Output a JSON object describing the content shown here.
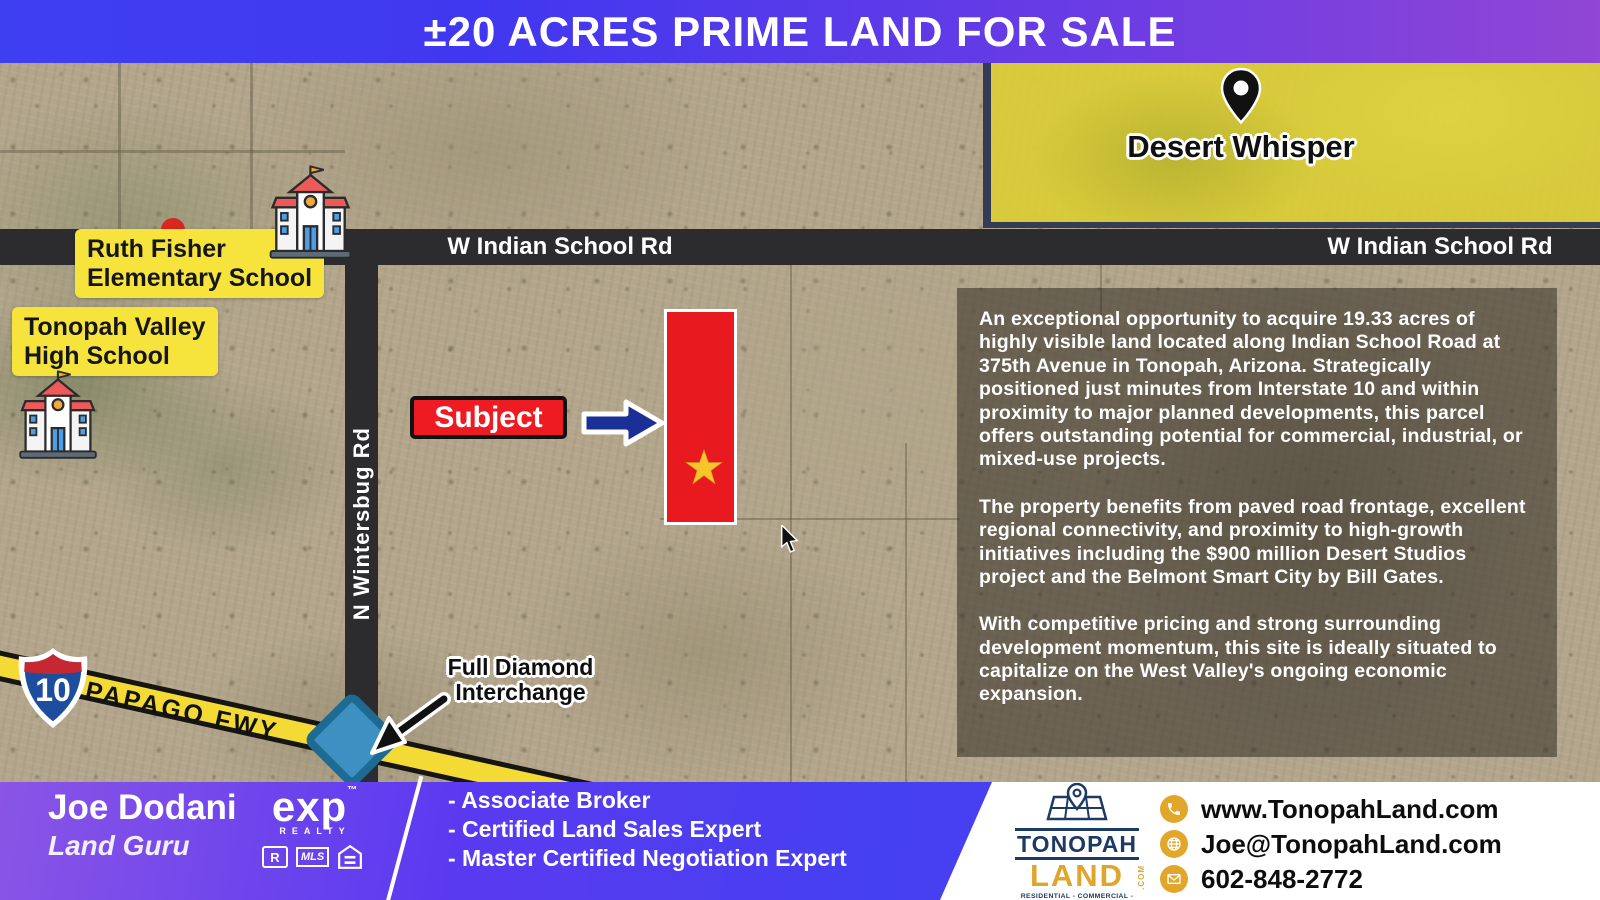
{
  "banner": {
    "title": "±20 ACRES PRIME LAND FOR SALE"
  },
  "map": {
    "desert_whisper": {
      "label": "Desert Whisper"
    },
    "roads": {
      "indian_school": "W Indian School Rd",
      "wintersburg": "N Wintersbug Rd",
      "papago": "PAPAGO FWY",
      "interstate": "10"
    },
    "schools": {
      "ruth_fisher": {
        "line1": "Ruth Fisher",
        "line2": "Elementary School"
      },
      "tonopah_valley": {
        "line1": "Tonopah Valley",
        "line2": "High School"
      }
    },
    "subject": {
      "label": "Subject"
    },
    "interchange": {
      "line1": "Full Diamond",
      "line2": "Interchange"
    },
    "description": {
      "p1": "An exceptional opportunity to acquire 19.33 acres of highly visible land located along Indian School Road at 375th Avenue in Tonopah, Arizona. Strategically positioned just minutes from Interstate 10 and within proximity to major planned developments, this parcel offers outstanding potential for commercial, industrial, or mixed-use projects.",
      "p2": "The property benefits from paved road frontage, excellent regional connectivity, and proximity to high-growth initiatives including the $900 million Desert Studios project and the Belmont Smart City by Bill Gates.",
      "p3": "With competitive pricing and strong surrounding development momentum, this site is ideally situated to capitalize on the West Valley's ongoing economic expansion."
    }
  },
  "footer": {
    "agent": {
      "name": "Joe Dodani",
      "title": "Land Guru"
    },
    "brokerage": {
      "name": "exp",
      "tm": "™",
      "realty": "REALTY",
      "realtor": "R",
      "mls": "MLS"
    },
    "credentials": [
      "- Associate Broker",
      "- Certified Land Sales Expert",
      "- Master Certified Negotiation Expert"
    ],
    "company": {
      "name_top": "TONOPAH",
      "name_bottom": "LAND",
      "com": ".COM",
      "tagline": "RESIDENTIAL - COMMERCIAL - INDUSTRIAL - SOLAR - FARM"
    },
    "contacts": [
      {
        "icon": "phone-icon",
        "text": "www.TonopahLand.com"
      },
      {
        "icon": "globe-icon",
        "text": "Joe@TonopahLand.com"
      },
      {
        "icon": "envelope-icon",
        "text": "602-848-2772"
      }
    ]
  },
  "colors": {
    "banner_blue": "#3f3ff2",
    "banner_purple": "#9146d4",
    "parcel_red": "#e8191f",
    "label_yellow": "#f6e33c",
    "desert_whisper_yellow": "#d9cb37",
    "road_dark": "#2c2c2e",
    "arrow_navy": "#1b2f96",
    "diamond_blue": "#3e90c2",
    "freeway_yellow": "#f4da34",
    "gold": "#e2a62a",
    "navy": "#1c3a63",
    "star_gold": "#f5c52c"
  }
}
